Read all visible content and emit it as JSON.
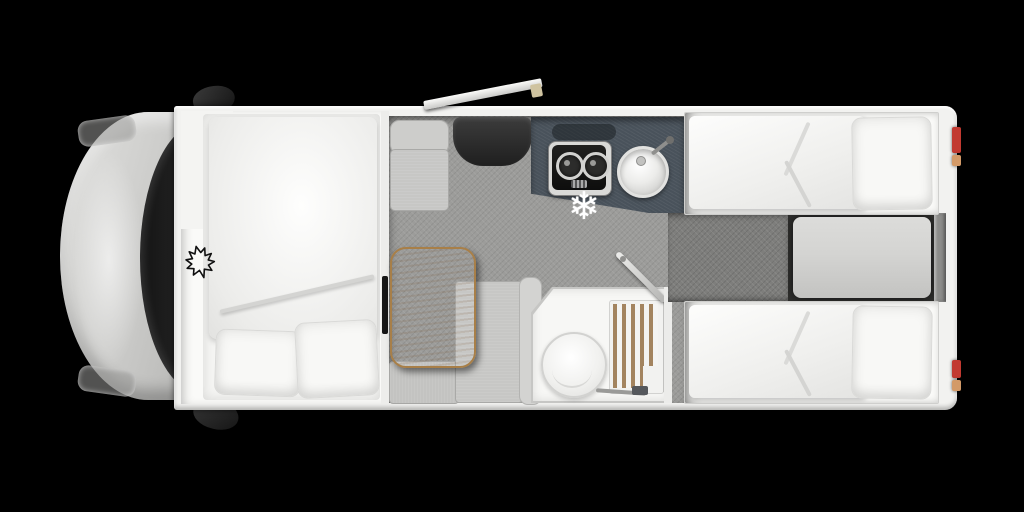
{
  "scene": {
    "kind": "motorhome-floorplan-top-view",
    "orientation": "front-of-vehicle-left"
  },
  "icons": {
    "fridge_snowflake": "❄",
    "brand_logo": "maple-leaf-icon"
  },
  "features": [
    {
      "name": "cab",
      "items": [
        "hood",
        "windshield",
        "side-mirror-top",
        "side-mirror-bottom",
        "headlights"
      ]
    },
    {
      "name": "front-bedroom",
      "items": [
        "drop-down-bed",
        "duvet",
        "pillow",
        "pillow",
        "maple-leaf-logo"
      ]
    },
    {
      "name": "lounge",
      "items": [
        "single-seat",
        "entry-step-mat",
        "dinette-table",
        "bench-seat",
        "bench-backrest",
        "tv-panel",
        "entry-door-open"
      ]
    },
    {
      "name": "kitchen",
      "items": [
        "counter",
        "two-burner-hob",
        "round-sink",
        "faucet",
        "fridge-snowflake-marker"
      ]
    },
    {
      "name": "bathroom",
      "items": [
        "toilet",
        "shower-tray",
        "wood-duckboard",
        "open-door",
        "shower-mixer"
      ]
    },
    {
      "name": "rear-bedroom",
      "items": [
        "single-bed-top",
        "single-bed-bottom",
        "walkway",
        "step-platform"
      ]
    },
    {
      "name": "exterior-rear",
      "items": [
        "taillight-red-top",
        "taillight-amber-top",
        "taillight-red-bottom",
        "taillight-amber-bottom"
      ]
    }
  ],
  "colors": {
    "background": "#000000",
    "body-wall": "#f2f2f0",
    "bedroom-floor": "#fafaf8",
    "bed-white": "#f5f5f3",
    "carpet": "#9c9c9a",
    "walkway": "#7e7e7c",
    "platform": "#d4d4d2",
    "counter": "#49525b",
    "entry-mat": "#2e2e2e",
    "seat": "#c7c7c5",
    "table-wood": "#c89c63",
    "table-edge": "#a87f48",
    "shower-wood": "#a3845f",
    "windshield": "#1d1d1d",
    "cab-silver": "#bcbcba",
    "taillight-red": "#c23a31",
    "taillight-amber": "#d39a68",
    "logo-ink": "#111111",
    "snowflake-white": "#ffffff"
  }
}
